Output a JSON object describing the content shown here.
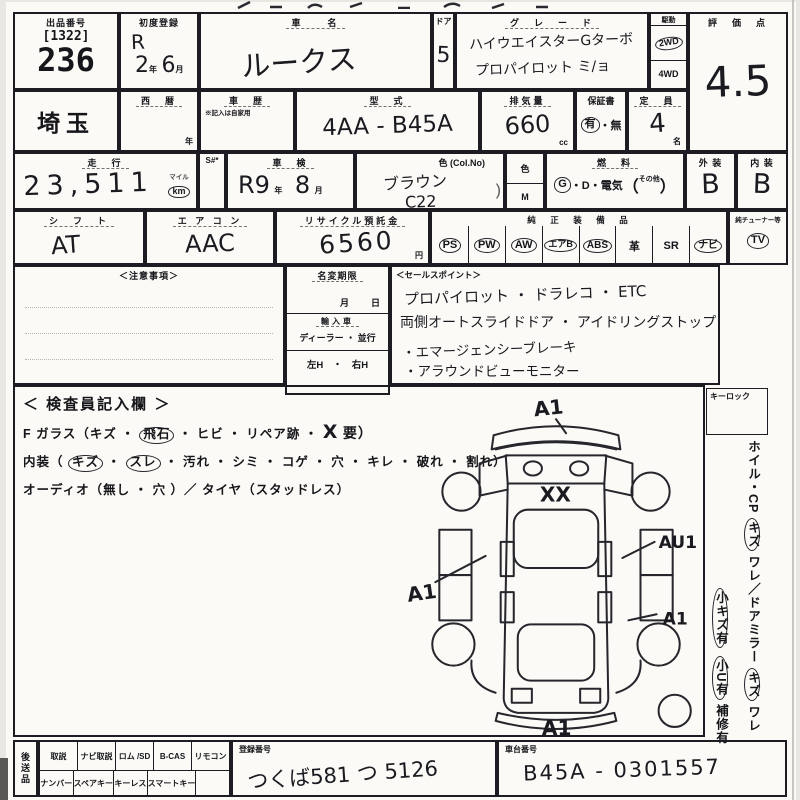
{
  "row1": {
    "lot": {
      "label": "出品番号",
      "bracket": "[1322]",
      "number": "236"
    },
    "first_reg": {
      "label": "初度登録",
      "era": "R",
      "year": "2",
      "year_u": "年",
      "month": "6",
      "month_u": "月"
    },
    "car_name": {
      "label": "車　　名",
      "value": "ルークス"
    },
    "door": {
      "label": "ドア",
      "value": "5"
    },
    "grade": {
      "label": "グ　レ　ー　ド",
      "line1": "ハイウエイスターGターボ",
      "line2": "プロパイロット ミ/ョ"
    },
    "drive": {
      "label": "駆動",
      "opt_2wd": "2WD",
      "opt_4wd": "4WD"
    },
    "score": {
      "label": "評　価　点",
      "value": "4.5"
    }
  },
  "row2": {
    "region": {
      "value": "埼玉"
    },
    "year_west": {
      "label": "西　暦",
      "unit": "年"
    },
    "history": {
      "label": "車　歴",
      "note": "※記入は自家用"
    },
    "model_code": {
      "label": "型　式",
      "value": "4AA - B45A"
    },
    "displacement": {
      "label": "排気量",
      "value": "660",
      "unit": "cc"
    },
    "warranty": {
      "label": "保証書",
      "yes": "有",
      "sep": "・",
      "no": "無"
    },
    "capacity": {
      "label": "定　員",
      "value": "4",
      "unit": "名"
    }
  },
  "row3": {
    "mileage": {
      "label": "走　行",
      "value": "23,511",
      "unit_top": "マイル",
      "unit": "km"
    },
    "s_col": {
      "label": "S#*"
    },
    "inspection": {
      "label": "車　検",
      "era": "R9",
      "year_u": "年",
      "month": "8",
      "month_u": "月"
    },
    "color": {
      "label": "色 (Col.No)",
      "name": "ブラウン",
      "code": "C22"
    },
    "color_m": {
      "top": "色",
      "bottom": "M"
    },
    "fuel": {
      "label": "燃　料",
      "g": "G",
      "mid": "・D・電気",
      "paren_open": "（",
      "other": "その他",
      "paren_close": "）"
    },
    "exterior": {
      "label": "外 装",
      "value": "B"
    },
    "interior": {
      "label": "内 装",
      "value": "B"
    }
  },
  "row4": {
    "shift": {
      "label": "シ　フ　ト",
      "value": "AT"
    },
    "aircon": {
      "label": "エ ア コ ン",
      "value": "AAC"
    },
    "recycle": {
      "label": "リサイクル預託金",
      "value": "6560",
      "unit": "円"
    },
    "equipment": {
      "label": "純　正　装　備　品",
      "items": [
        {
          "t": "PS",
          "c": true
        },
        {
          "t": "PW",
          "c": true
        },
        {
          "t": "AW",
          "c": true
        },
        {
          "t": "エアB",
          "c": true
        },
        {
          "t": "ABS",
          "c": true
        },
        {
          "t": "革",
          "c": false
        },
        {
          "t": "SR",
          "c": false
        },
        {
          "t": "ナビ",
          "c": true
        }
      ]
    },
    "tuner": {
      "label": "純チューナー等",
      "item": "TV",
      "c": true
    }
  },
  "row5": {
    "notes": {
      "label": "＜注意事項＞"
    },
    "name_change": {
      "label": "名変期限",
      "month_u": "月",
      "day_u": "日",
      "import_label": "輸入車",
      "import_opts": "ディーラー ・ 並行",
      "handle_opts": "左H　・　右H"
    },
    "sales": {
      "label": "＜セールスポイント＞",
      "lines": [
        "プロパイロット ・ ドラレコ ・ ETC",
        "両側オートスライドドア ・ アイドリングストップ",
        "・エマージェンシーブレーキ",
        "・アラウンドビューモニター"
      ]
    }
  },
  "inspector": {
    "title": "＜ 検査員記入欄 ＞",
    "fglass": {
      "pre": "F ガラス（キズ ・",
      "circled": "飛石",
      "mid": "・ ヒビ ・ リペア跡 ・",
      "mark": "X",
      "post": "要）"
    },
    "interior_line": {
      "pre": "内装（",
      "c1": "キズ",
      "sep": "・",
      "c2": "スレ",
      "post": "・ 汚れ ・ シミ ・ コゲ ・ 穴 ・ キレ ・ 破れ ・ 割れ）"
    },
    "audio_line": "オーディオ（無し ・ 穴 ）／ タイヤ（スタッドレス）",
    "diagram": {
      "front": "A1",
      "hood": "XX",
      "left": "A1",
      "right_upper": "AU1",
      "right_lower": "A1",
      "rear": "A1"
    }
  },
  "sidebar": {
    "keylock": "キーロック",
    "wheel_line": {
      "pre": "ホイル・CP",
      "c1": "キズ",
      "mid": "ワレ／ドアミラー",
      "c2": "キズ",
      "post": "ワレ"
    },
    "scratch_line": {
      "c1": "小キズ有",
      "c2": "小U有",
      "post": "補修有"
    }
  },
  "bottom": {
    "later_items": "後送品",
    "grid": [
      {
        "top": "取説",
        "bottom": "ナンバー"
      },
      {
        "top": "ナビ取説",
        "bottom": "スペアキー"
      },
      {
        "top": "ロム /SD",
        "bottom": "キーレス"
      },
      {
        "top": "B-CAS",
        "bottom": "スマートキー"
      },
      {
        "top": "リモコン",
        "bottom": ""
      }
    ],
    "reg_no": {
      "label": "登録番号",
      "value": "つくば581 つ 5126"
    },
    "chassis": {
      "label": "車台番号",
      "value": "B45A - 0301557"
    }
  }
}
